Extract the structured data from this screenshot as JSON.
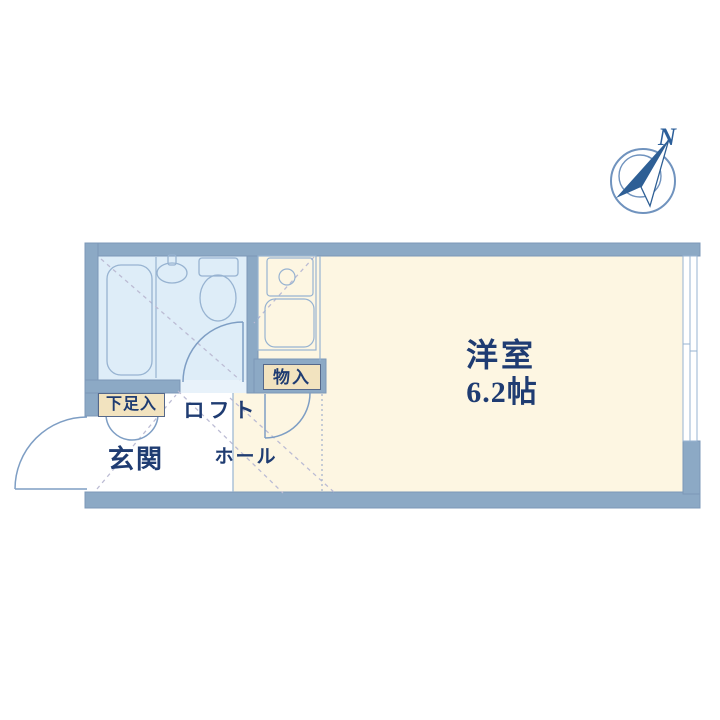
{
  "compass": {
    "north_label": "N"
  },
  "rooms": {
    "main_room": {
      "name": "洋室",
      "size": "6.2帖"
    },
    "loft": {
      "name": "ロフト"
    },
    "hall": {
      "name": "ホール"
    },
    "entrance": {
      "name": "玄関"
    },
    "shoe_storage": {
      "name": "下足入"
    },
    "closet": {
      "name": "物入"
    }
  },
  "fixtures": {
    "bathtub": "bathtub",
    "toilet": "toilet",
    "washbasin": "washbasin",
    "kitchen_counter": "kitchen-counter-with-sink",
    "window": "sliding-window",
    "doors": [
      "entrance-door",
      "bathroom-door",
      "closet-door",
      "shoe-cabinet-double-door"
    ]
  },
  "colors": {
    "wall": "#8ca9c5",
    "bathroom_floor": "#deedf8",
    "room_floor": "#fdf6e2",
    "entrance_floor": "#ffffff",
    "label_box": "#f2e3bf",
    "text": "#1f3c72",
    "thin_line": "#97b3d1",
    "door_line": "#7e9ec4",
    "dashed_line": "#bcbcd4",
    "compass_blue": "#2e5f95"
  }
}
